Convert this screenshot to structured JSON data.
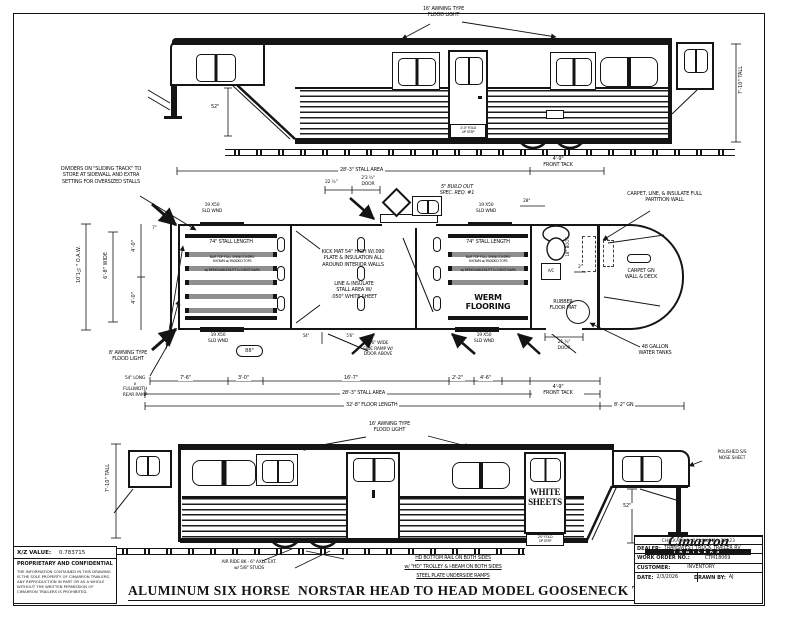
{
  "colors": {
    "ink": "#141414",
    "divider_gray": "#8f8f8f"
  },
  "view_top": {
    "flood_light": "16' AWNING TYPE\nFLOOD LIGHT",
    "tall": "7'-10\" TALL",
    "drop": "52\"",
    "step": "2'-0\" FOLD\nUP STEP"
  },
  "plan": {
    "dividers_note": "DIVIDERS ON \"SLIDING TRACK\" TO\nSTORE AT SIDEWALL AND EXTRA\nSETTING FOR OVERSIZED STALLS",
    "stall_area_top": "28'-3\" STALL AREA",
    "front_tack_top": "4'-9\"\nFRONT TACK",
    "build_out": "5\" BUILD OUT\nSPEC. REQ. #1",
    "dim_22half": "22 ½\"",
    "door_dim_top": "2'3 ¾\"\nDOOR",
    "carpet_partition": "CARPET, LINE, & INSULATE FULL\nPARTITION WALL",
    "sld_wnd": "19 X50\nSLD WND",
    "stall_length": "74\" STALL LENGTH",
    "stall_note_a": "BAR TOP FULL SWING DVDRS\nSHOWN w/ PADDED TOPS",
    "stall_note_b": "w/ REMOVABLE BUTT & CHEST BARS",
    "kick_mat": "KICK MAT 54\" HIGH W/.090\nPLATE & INSULATION ALL\nAROUND INTERIOR WALLS",
    "line_insulate": "LINE & INSULATE\nSTALL AREA W/\n.050\" WHITE SHEET",
    "werm": "WERM\nFLOORING",
    "side_ramp": "5'6\" WIDE\nSIDE RAMP W/\nDOOR ABOVE",
    "rubber_mat": "RUBBER\nFLOOR MAT",
    "carpet_gn": "CARPET GN\nWALL & DECK",
    "water_tanks": "48 GALLON\nWATER TANKS",
    "awning8": "8' AWNING TYPE\nFLOOD LIGHT",
    "oaw": "10'1½\" O.A.W.",
    "wide": "6'-8\" WIDE",
    "dim_40": "4'-0\"",
    "dim_7": "7\"",
    "dim_88": "88\"",
    "dim_54": "54\"",
    "dim_56": "5'6\"",
    "dim_28": "28\"",
    "dim_2": "2\"",
    "boot": "18\" BOOT",
    "ac": "A/C",
    "door_dim_right": "21 ¾\"\nDOOR",
    "rear_ramp": "54\" LONG\nx\nFULLWIDTH\nREAR RAMP",
    "dim_76": "7'-6\"",
    "dim_30": "3'-0\"",
    "dim_167": "16'-7\"",
    "dim_22ft": "2'-2\"",
    "dim_46": "4'-6\"",
    "stall_area_bottom": "28'-3\" STALL AREA",
    "floor_length": "32'-8\" FLOOR LENGTH",
    "front_tack_bottom": "4'-9\"\nFRONT TACK",
    "gn": "8'-2\" GN"
  },
  "view_bottom": {
    "flood_light": "16' AWNING TYPE\nFLOOD LIGHT",
    "tall": "7'-10\" TALL",
    "white_sheets": "WHITE\nSHEETS",
    "step": "2'0\" FOLD\nUP STEP",
    "nose": "POLISHED S/S\nNOSE SHEET",
    "drop": "52\""
  },
  "notes": {
    "air_ride": "AIR RIDE 8K - 6\" AXLE EXT.\nw/ 5/8\" STUDS",
    "hd1": "HD BOTTOM RAIL ON BOTH SIDES",
    "hd2": "w/ \"HD\" TROLLEY & I-BEAM ON BOTH SIDES",
    "hd3": "STEEL PLATE UNDERSIDE RAMPS"
  },
  "footer_title": "ALUMINUM SIX HORSE  NORSTAR HEAD TO HEAD MODEL GOOSENECK TRAILER",
  "xz": {
    "label": "X/Z VALUE:",
    "value": "0.783715"
  },
  "proprietary": {
    "heading": "PROPRIETARY AND CONFIDENTIAL",
    "body": "THE INFORMATION CONTAINED IN THIS DRAWING IS THE SOLE PROPERTY OF CIMARRON TRAILERS. ANY REPRODUCTION IN PART OR AS A WHOLE WITHOUT THE WRITTEN PERMISSION OF CIMARRON TRAILERS IS PROHIBITED."
  },
  "title_block": {
    "brand": "Cimarron",
    "brand_sub": "TRAILERS",
    "city": "CHICKASHA, OKLAHOMA 73023",
    "dealer_label": "DEALER:",
    "dealer": "TRANSWEST TRUCK TRAILER RV",
    "wo_label": "WORK ORDER NO.:",
    "wo": "CTM18069",
    "customer_label": "CUSTOMER:",
    "customer": "INVENTORY",
    "date_label": "DATE:",
    "date": "2/3/2026",
    "drawn_label": "DRAWN BY:",
    "drawn": "AJ"
  }
}
